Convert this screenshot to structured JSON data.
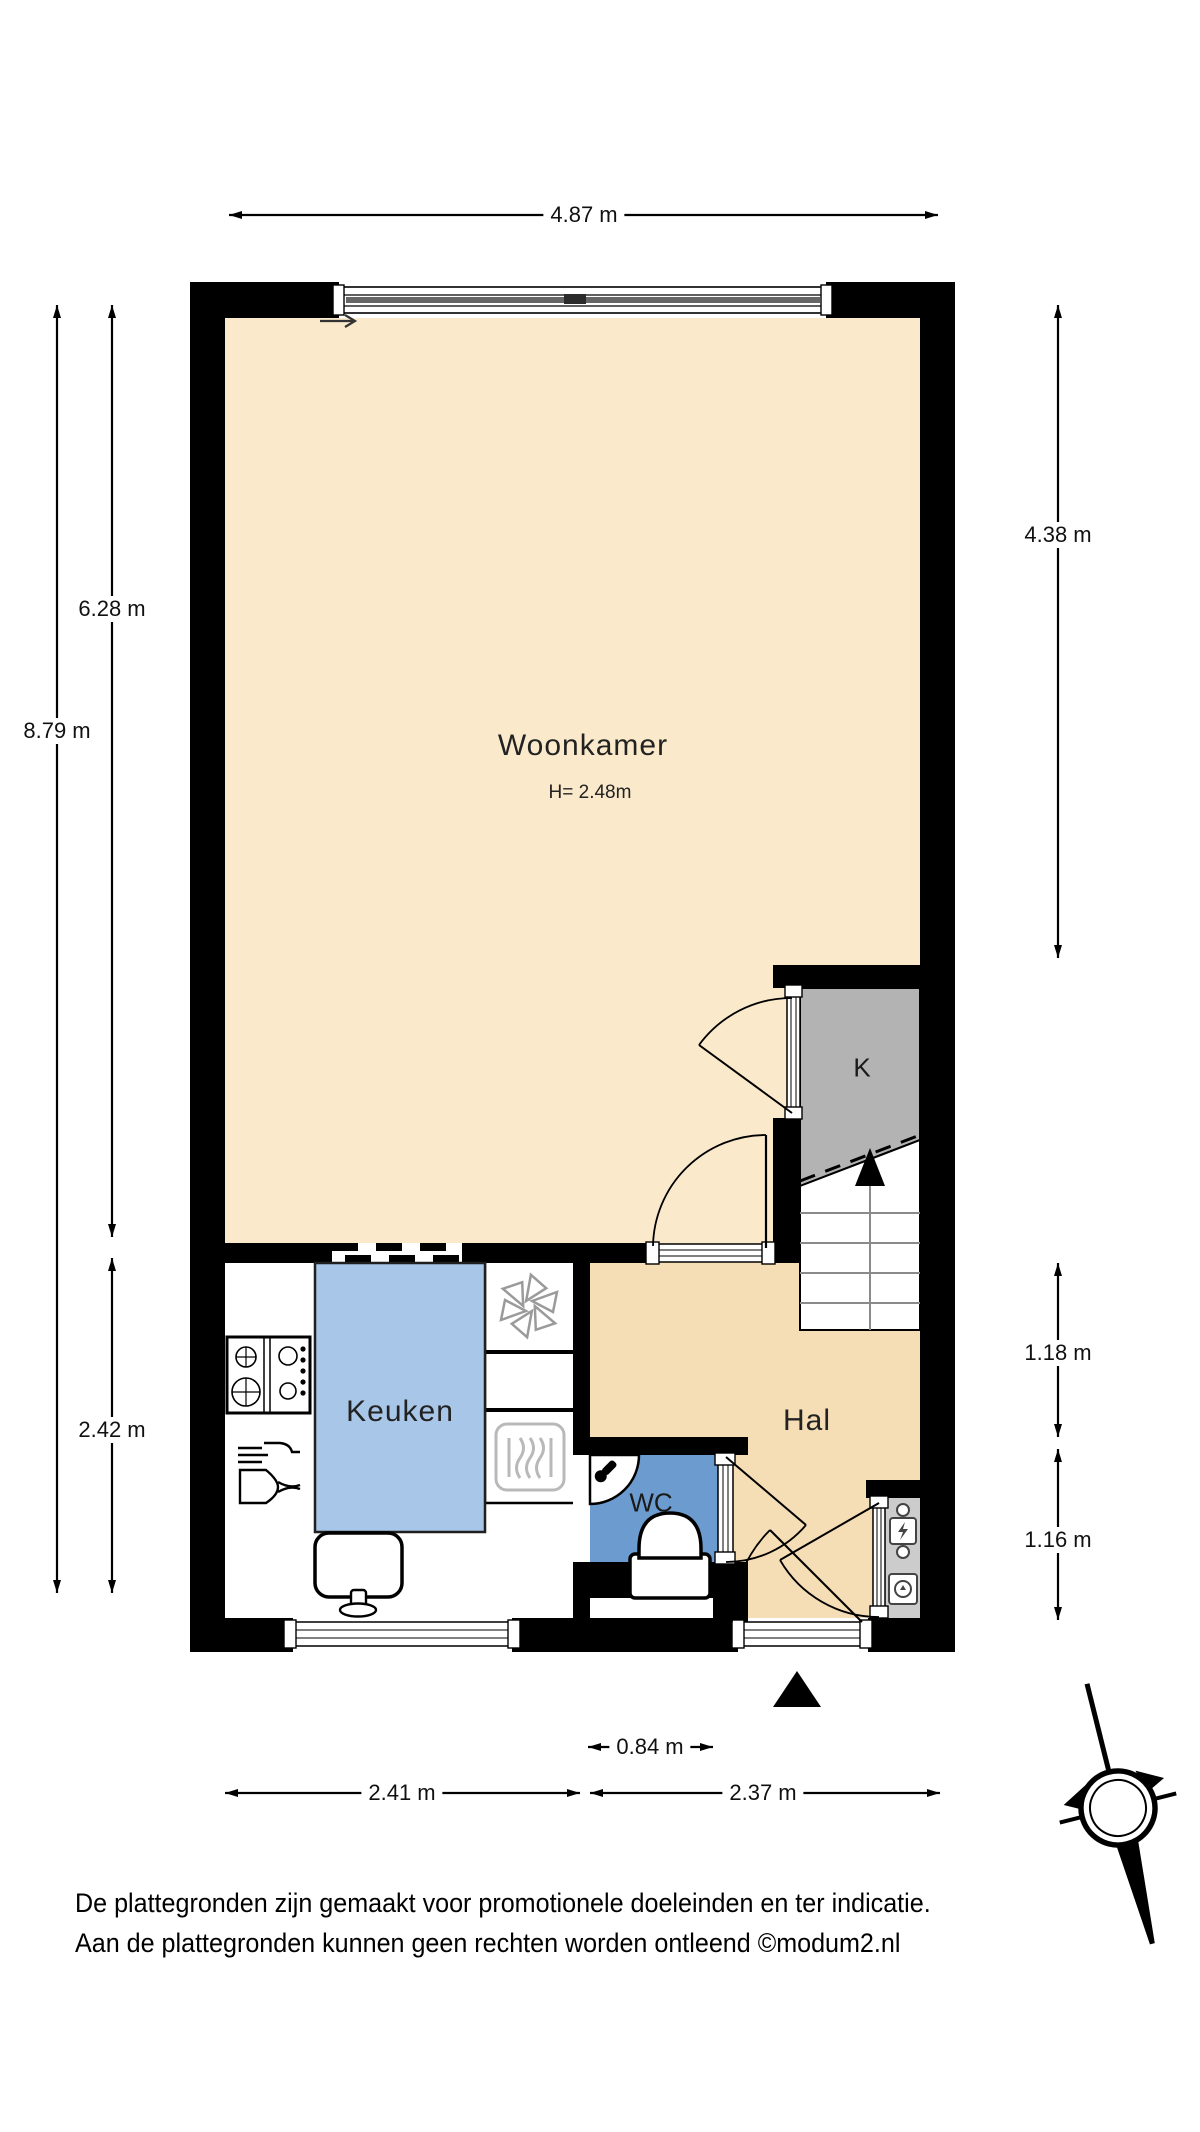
{
  "rooms": {
    "woonkamer": {
      "label": "Woonkamer",
      "ceiling_height": "H= 2.48m"
    },
    "keuken": {
      "label": "Keuken"
    },
    "hal": {
      "label": "Hal"
    },
    "wc": {
      "label": "WC"
    },
    "closet": {
      "label": "K"
    }
  },
  "dimensions": {
    "top_width": "4.87 m",
    "left_total_height": "8.79 m",
    "left_woonkamer_height": "6.28 m",
    "left_keuken_height": "2.42 m",
    "right_woonkamer_height": "4.38 m",
    "right_hal_upper": "1.18 m",
    "right_hal_lower": "1.16 m",
    "bottom_wc_width": "0.84 m",
    "bottom_keuken_width": "2.41 m",
    "bottom_hal_width": "2.37 m"
  },
  "compass": {
    "north_label": "N"
  },
  "footer": {
    "line1": "De plattegronden zijn gemaakt voor promotionele doeleinden en ter indicatie.",
    "line2": "Aan de plattegronden kunnen geen rechten worden ontleend ©modum2.nl"
  },
  "colors": {
    "floor_cream": "#FAEACB",
    "floor_tan": "#F5DDB5",
    "table_blue": "#A8C7E8",
    "wc_blue": "#6C9CCF",
    "closet_gray": "#B3B3B3",
    "meter_gray": "#CCCCCC",
    "wall_black": "#000000",
    "appliance_gray": "#BBBBBB"
  }
}
